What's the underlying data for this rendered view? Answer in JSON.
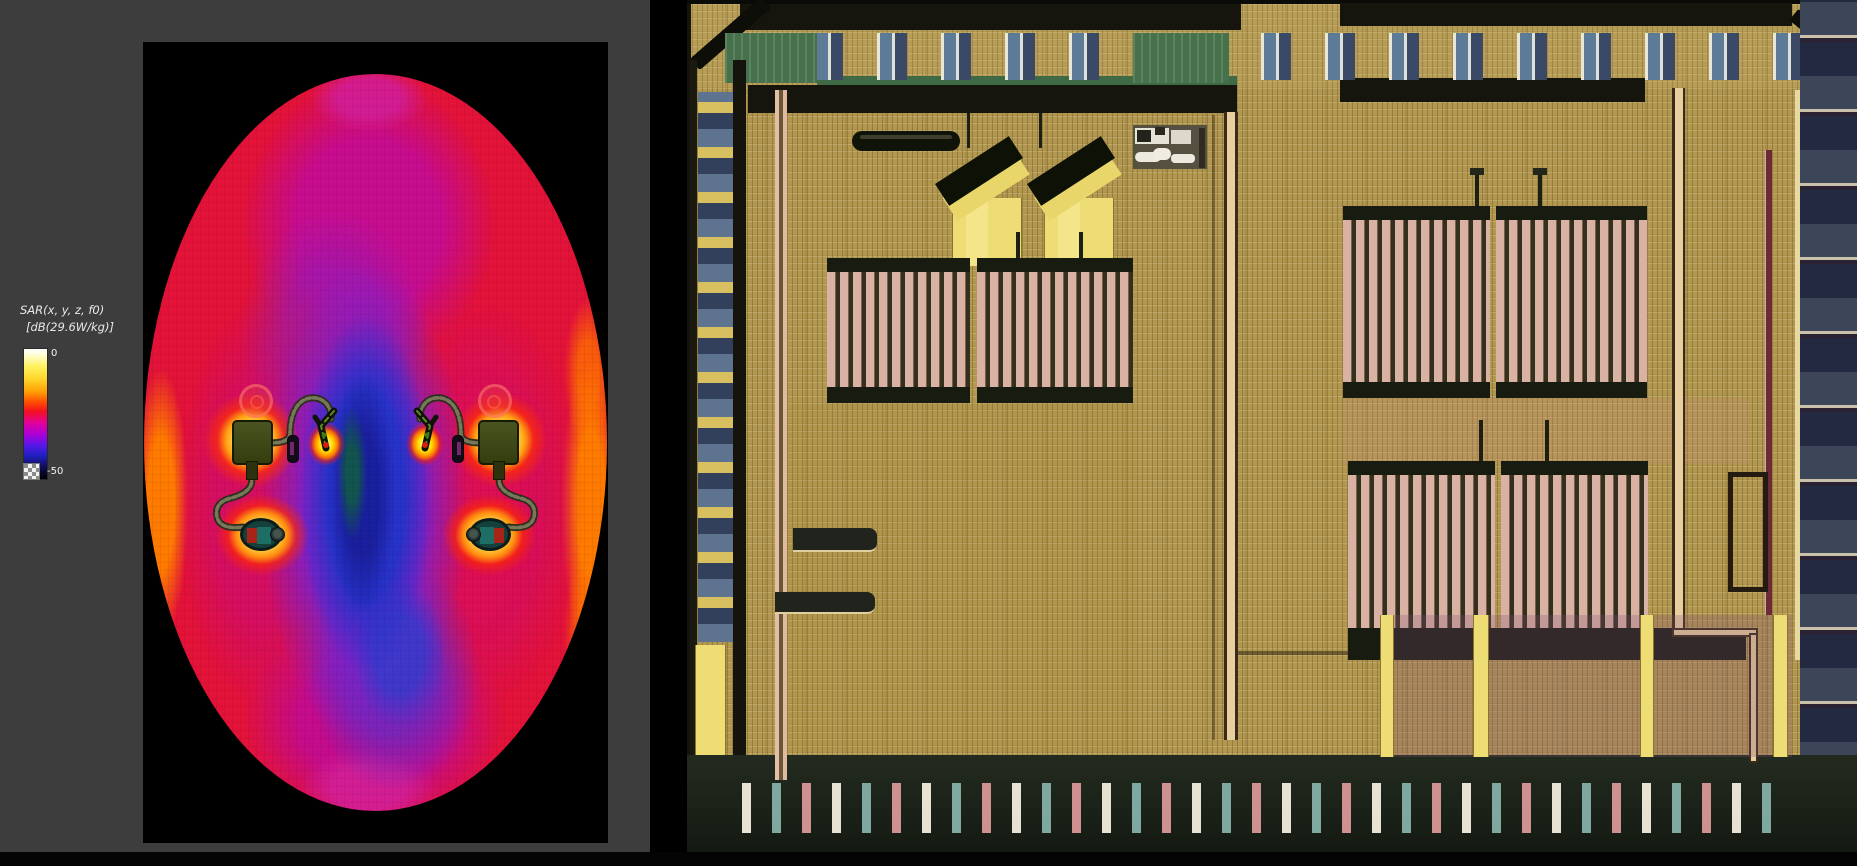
{
  "window": {
    "background": "#3d3d3d",
    "plot_background": "#000000",
    "separator_color": "#000000"
  },
  "legend": {
    "title_line1": "SAR(x, y, z, f0)",
    "title_line2": "[dB(29.6W/kg)]",
    "max_label": "0",
    "min_label": "-50"
  },
  "chart_data": {
    "type": "heatmap",
    "title": "SAR(x, y, z, f0)",
    "units": "dB(29.6W/kg)",
    "colorbar": {
      "orientation": "vertical",
      "position": "left",
      "max": 0,
      "min": -50,
      "tick_labels": [
        "0",
        "-50"
      ],
      "gradient_top_to_bottom": [
        "#ffffff",
        "#fff262",
        "#ffd629",
        "#ff9e06",
        "#ff4c00",
        "#f31020",
        "#e2009c",
        "#a800d8",
        "#5818e8",
        "#2020c0",
        "#101060",
        "#000000"
      ],
      "below_range_marker": "transparent-checkerboard"
    },
    "field": {
      "shape": "elliptical head phantom, axial slice",
      "value_range_db": [
        -50,
        0
      ],
      "peak_regions": "two symmetric device bodies, antenna tips and round earpieces (white/yellow hotspots, ~0 dB)",
      "low_region": "central column between the two devices (blue/teal, ~-35 to -45 dB)",
      "bulk_region": "tissue bulk red/magenta (~-10 to -25 dB)",
      "symmetry": "left-right mirrored pair of hearing-instrument devices"
    },
    "grid": false,
    "legend_position": "left"
  },
  "panels": {
    "left": "sar-simulation-heatmap",
    "right": "ic-die-micrograph"
  },
  "colors": {
    "heat_red": "#e31238",
    "heat_magenta": "#c70c8e",
    "heat_purple": "#7a22cc",
    "heat_blue": "#2732c8",
    "heat_teal_core": "#11584a",
    "chip_base_tan": "#b29750",
    "chip_dark_rail": "#15150d",
    "chip_comb_pink": "#d9b2a4",
    "chip_pad_blue": "#5d7a96",
    "chip_yellow": "#e9d66b"
  }
}
